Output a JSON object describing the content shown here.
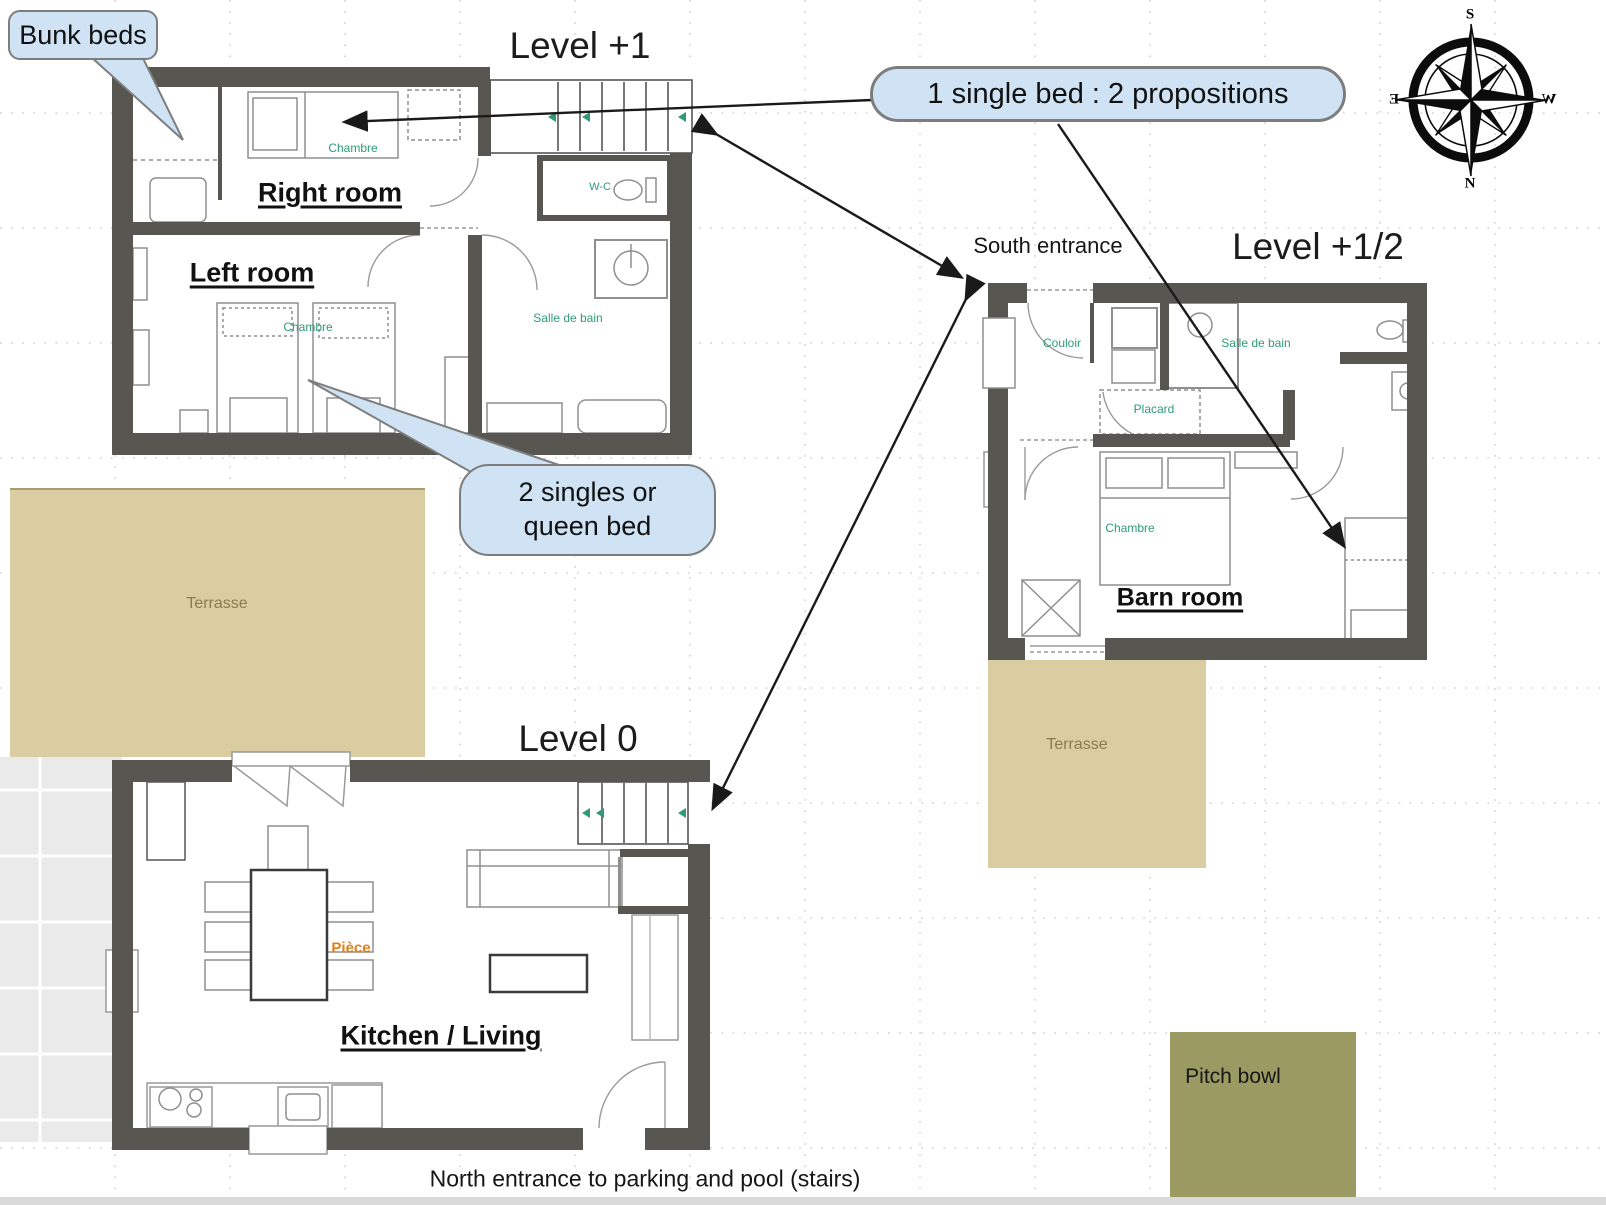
{
  "callouts": {
    "bunk_beds": "Bunk beds",
    "single_bed": "1 single bed : 2 propositions",
    "queen_line1": "2 singles or",
    "queen_line2": "queen bed"
  },
  "titles": {
    "level_plus_1": "Level +1",
    "level_plus_half": "Level +1/2",
    "level_0": "Level 0"
  },
  "entrances": {
    "south": "South entrance",
    "north": "North entrance to parking and pool (stairs)"
  },
  "rooms": {
    "right_room": "Right room",
    "left_room": "Left room",
    "kitchen_living": "Kitchen / Living",
    "barn_room": "Barn room"
  },
  "plan_labels": {
    "chambre": "Chambre",
    "salle_de_bain": "Salle de bain",
    "wc": "W-C",
    "couloir": "Couloir",
    "placard": "Placard",
    "piece": "Pièce",
    "terrasse": "Terrasse"
  },
  "outdoor": {
    "pitch_bowl": "Pitch bowl"
  },
  "compass": {
    "top": "S",
    "bottom": "N",
    "left": "E",
    "right": "W"
  },
  "colors": {
    "wall": "#575650",
    "terrace": "#D9CDA1",
    "pitch_bowl": "#9A9A62",
    "callout_fill": "#CFE3F5",
    "label_teal": "#2E9B77",
    "label_orange": "#E07D1A"
  }
}
